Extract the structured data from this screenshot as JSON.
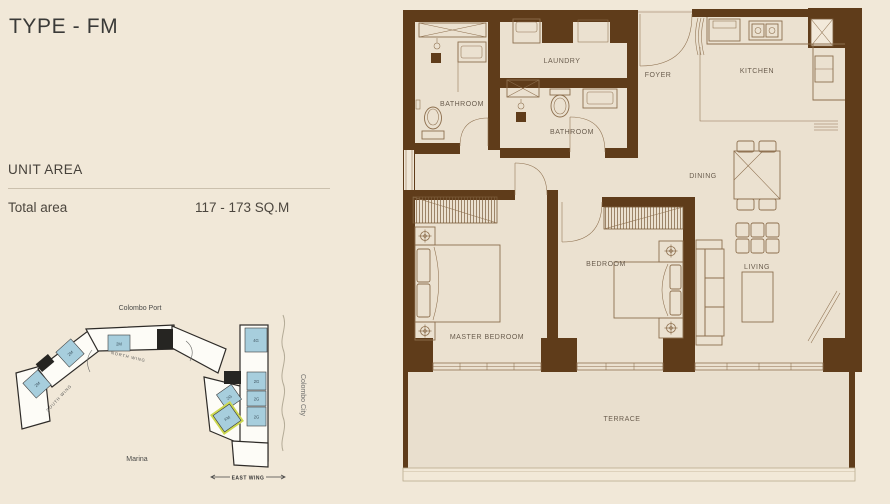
{
  "page": {
    "type_title": "TYPE - FM"
  },
  "unit_area": {
    "heading": "UNIT AREA",
    "label": "Total area",
    "value": "117 - 173 SQ.M"
  },
  "key_plan": {
    "port_label": "Colombo Port",
    "city_label": "Colombo City",
    "marina_label": "Marina",
    "east_wing_label": "EAST WING",
    "north_wing_label": "NORTH WING",
    "south_wing_label": "SOUTH WING",
    "unit_fill_color": "#a7cedd",
    "highlight_color": "#ccd84f",
    "units": [
      {
        "label": "2M"
      },
      {
        "label": "2M"
      },
      {
        "label": "2M"
      },
      {
        "label": "4G"
      },
      {
        "label": "2G"
      },
      {
        "label": "2G"
      },
      {
        "label": "2G"
      },
      {
        "label": "2G"
      },
      {
        "label": "FM"
      }
    ]
  },
  "floor_plan": {
    "colors": {
      "wall": "#5f3c1a",
      "floor": "#ebe1d0",
      "furniture_line": "#8d6f4e"
    },
    "rooms": [
      {
        "id": "bathroom-1",
        "label": "BATHROOM"
      },
      {
        "id": "laundry",
        "label": "LAUNDRY"
      },
      {
        "id": "bathroom-2",
        "label": "BATHROOM"
      },
      {
        "id": "foyer",
        "label": "FOYER"
      },
      {
        "id": "kitchen",
        "label": "KITCHEN"
      },
      {
        "id": "dining",
        "label": "DINING"
      },
      {
        "id": "bedroom",
        "label": "BEDROOM"
      },
      {
        "id": "living",
        "label": "LIVING"
      },
      {
        "id": "master-bedroom",
        "label": "MASTER BEDROOM"
      },
      {
        "id": "terrace",
        "label": "TERRACE"
      }
    ]
  }
}
